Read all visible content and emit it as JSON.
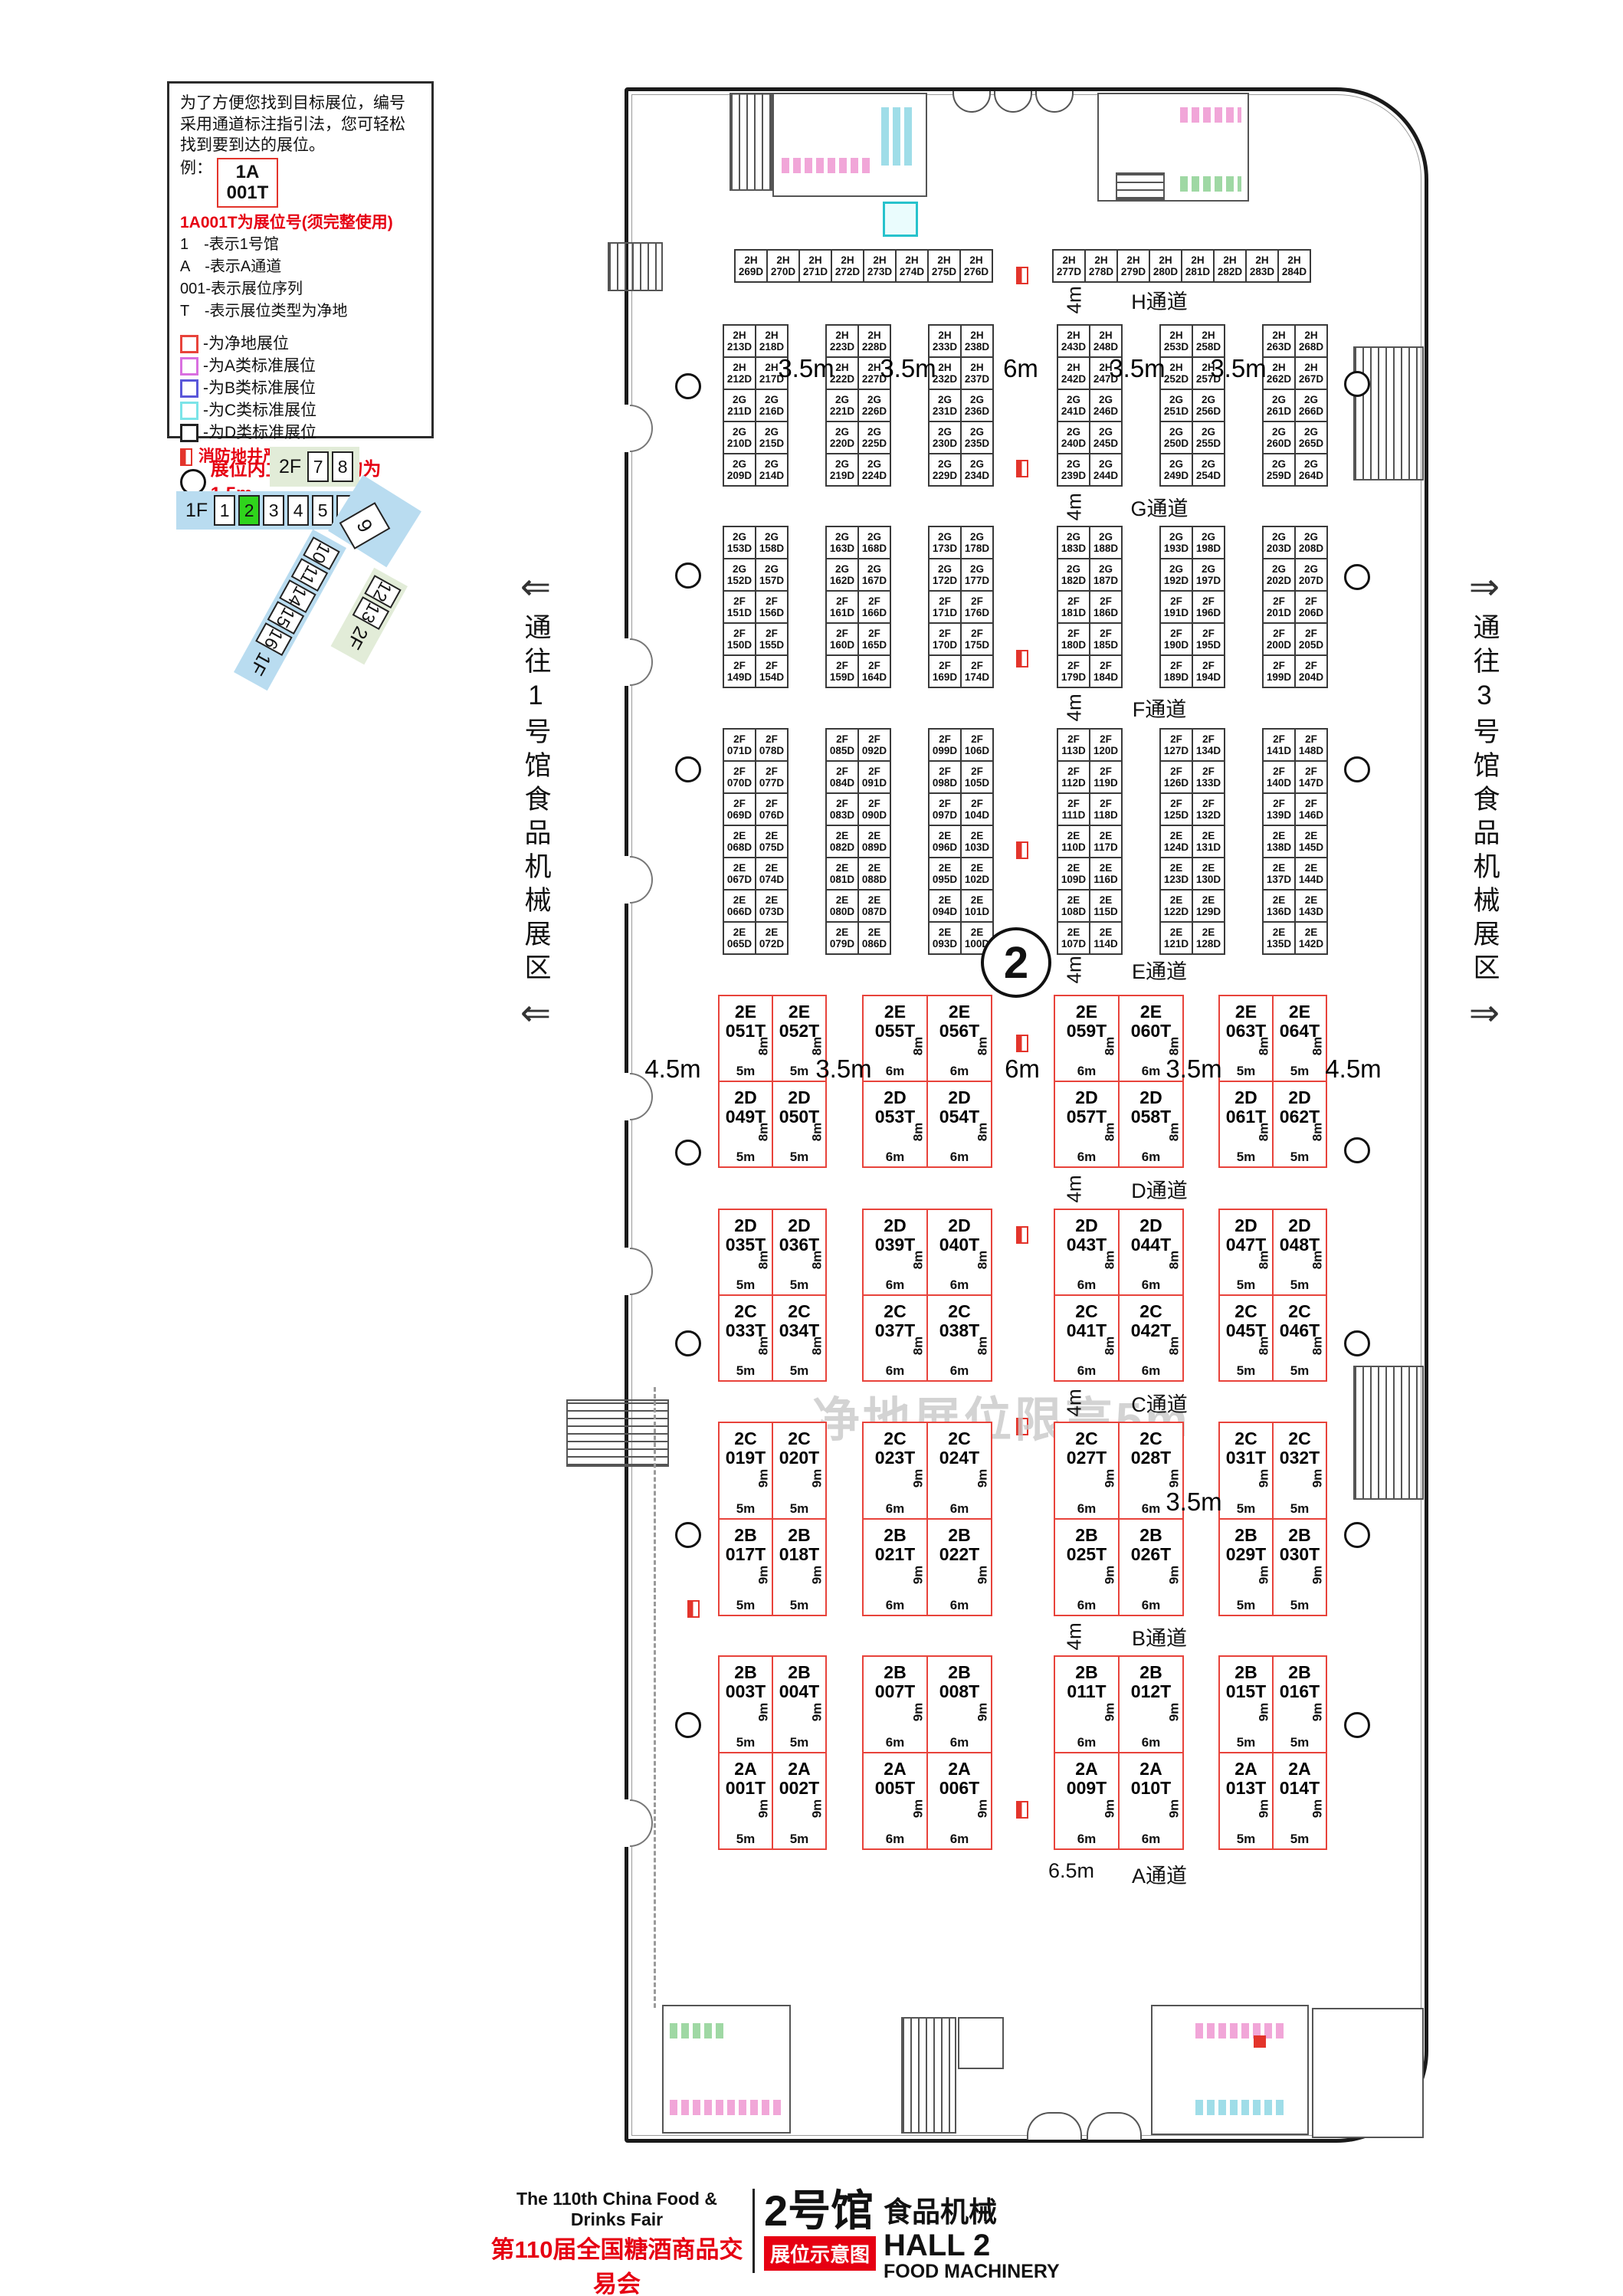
{
  "legend": {
    "intro": "为了方便您找到目标展位，编号采用通道标注指引法，您可轻松找到要到达的展位。",
    "example_label": "例：",
    "example_booth_line1": "1A",
    "example_booth_line2": "001T",
    "booth_no_note": "1A001T为展位号(须完整使用)",
    "notes": [
      "1　-表示1号馆",
      "A　-表示A通道",
      "001-表示展位序列",
      "T　-表示展位类型为净地"
    ],
    "classes": [
      {
        "color": "#e8433b",
        "label": "-为净地展位"
      },
      {
        "color": "#d96fe0",
        "label": "-为A类标准展位"
      },
      {
        "color": "#5a57d9",
        "label": "-为B类标准展位"
      },
      {
        "color": "#7ce4e8",
        "label": "-为C类标准展位"
      },
      {
        "color": "#222222",
        "label": "-为D类标准展位"
      }
    ],
    "fire_note": "消防地井严禁遮挡",
    "column_note": "展位内立柱 直径均为1.5m"
  },
  "minimap": {
    "floor2_label": "2F",
    "floor2_halls": [
      "7",
      "8"
    ],
    "floor1_label": "1F",
    "floor1_halls": [
      "1",
      "2",
      "3",
      "4",
      "5",
      "6"
    ],
    "current_hall": "2",
    "hall9": "9",
    "diag1_halls": [
      "10",
      "11",
      "14",
      "15",
      "16"
    ],
    "diag1_label": "1F",
    "diag2_halls": [
      "12",
      "13"
    ],
    "diag2_label": "2F",
    "highlight_color": "#2fd41c",
    "blue": "#b9dcf0",
    "green": "#e2ecd8"
  },
  "corridors": {
    "left": "通往1号馆食品机械展区",
    "right": "通往3号馆食品机械展区"
  },
  "hall_badge": "2",
  "watermark": "净地展位限高5m",
  "plan": {
    "top_row_left": [
      "2H269D",
      "2H270D",
      "2H271D",
      "2H272D",
      "2H273D",
      "2H274D",
      "2H275D",
      "2H276D"
    ],
    "top_row_right": [
      "2H277D",
      "2H278D",
      "2H279D",
      "2H280D",
      "2H281D",
      "2H282D",
      "2H283D",
      "2H284D"
    ],
    "grid_hg": [
      [
        [
          "2H213D",
          "2H218D"
        ],
        [
          "2H212D",
          "2H217D"
        ],
        [
          "2G211D",
          "2G216D"
        ],
        [
          "2G210D",
          "2G215D"
        ],
        [
          "2G209D",
          "2G214D"
        ]
      ],
      [
        [
          "2H223D",
          "2H228D"
        ],
        [
          "2H222D",
          "2H227D"
        ],
        [
          "2G221D",
          "2G226D"
        ],
        [
          "2G220D",
          "2G225D"
        ],
        [
          "2G219D",
          "2G224D"
        ]
      ],
      [
        [
          "2H233D",
          "2H238D"
        ],
        [
          "2H232D",
          "2H237D"
        ],
        [
          "2G231D",
          "2G236D"
        ],
        [
          "2G230D",
          "2G235D"
        ],
        [
          "2G229D",
          "2G234D"
        ]
      ],
      [
        [
          "2H243D",
          "2H248D"
        ],
        [
          "2H242D",
          "2H247D"
        ],
        [
          "2G241D",
          "2G246D"
        ],
        [
          "2G240D",
          "2G245D"
        ],
        [
          "2G239D",
          "2G244D"
        ]
      ],
      [
        [
          "2H253D",
          "2H258D"
        ],
        [
          "2H252D",
          "2H257D"
        ],
        [
          "2G251D",
          "2G256D"
        ],
        [
          "2G250D",
          "2G255D"
        ],
        [
          "2G249D",
          "2G254D"
        ]
      ],
      [
        [
          "2H263D",
          "2H268D"
        ],
        [
          "2H262D",
          "2H267D"
        ],
        [
          "2G261D",
          "2G266D"
        ],
        [
          "2G260D",
          "2G265D"
        ],
        [
          "2G259D",
          "2G264D"
        ]
      ]
    ],
    "grid_gf": [
      [
        [
          "2G153D",
          "2G158D"
        ],
        [
          "2G152D",
          "2G157D"
        ],
        [
          "2F151D",
          "2F156D"
        ],
        [
          "2F150D",
          "2F155D"
        ],
        [
          "2F149D",
          "2F154D"
        ]
      ],
      [
        [
          "2G163D",
          "2G168D"
        ],
        [
          "2G162D",
          "2G167D"
        ],
        [
          "2F161D",
          "2F166D"
        ],
        [
          "2F160D",
          "2F165D"
        ],
        [
          "2F159D",
          "2F164D"
        ]
      ],
      [
        [
          "2G173D",
          "2G178D"
        ],
        [
          "2G172D",
          "2G177D"
        ],
        [
          "2F171D",
          "2F176D"
        ],
        [
          "2F170D",
          "2F175D"
        ],
        [
          "2F169D",
          "2F174D"
        ]
      ],
      [
        [
          "2G183D",
          "2G188D"
        ],
        [
          "2G182D",
          "2G187D"
        ],
        [
          "2F181D",
          "2F186D"
        ],
        [
          "2F180D",
          "2F185D"
        ],
        [
          "2F179D",
          "2F184D"
        ]
      ],
      [
        [
          "2G193D",
          "2G198D"
        ],
        [
          "2G192D",
          "2G197D"
        ],
        [
          "2F191D",
          "2F196D"
        ],
        [
          "2F190D",
          "2F195D"
        ],
        [
          "2F189D",
          "2F194D"
        ]
      ],
      [
        [
          "2G203D",
          "2G208D"
        ],
        [
          "2G202D",
          "2G207D"
        ],
        [
          "2F201D",
          "2F206D"
        ],
        [
          "2F200D",
          "2F205D"
        ],
        [
          "2F199D",
          "2F204D"
        ]
      ]
    ],
    "grid_fe": [
      [
        [
          "2F071D",
          "2F078D"
        ],
        [
          "2F070D",
          "2F077D"
        ],
        [
          "2F069D",
          "2F076D"
        ],
        [
          "2E068D",
          "2E075D"
        ],
        [
          "2E067D",
          "2E074D"
        ],
        [
          "2E066D",
          "2E073D"
        ],
        [
          "2E065D",
          "2E072D"
        ]
      ],
      [
        [
          "2F085D",
          "2F092D"
        ],
        [
          "2F084D",
          "2F091D"
        ],
        [
          "2F083D",
          "2F090D"
        ],
        [
          "2E082D",
          "2E089D"
        ],
        [
          "2E081D",
          "2E088D"
        ],
        [
          "2E080D",
          "2E087D"
        ],
        [
          "2E079D",
          "2E086D"
        ]
      ],
      [
        [
          "2F099D",
          "2F106D"
        ],
        [
          "2F098D",
          "2F105D"
        ],
        [
          "2F097D",
          "2F104D"
        ],
        [
          "2E096D",
          "2E103D"
        ],
        [
          "2E095D",
          "2E102D"
        ],
        [
          "2E094D",
          "2E101D"
        ],
        [
          "2E093D",
          "2E100D"
        ]
      ],
      [
        [
          "2F113D",
          "2F120D"
        ],
        [
          "2F112D",
          "2F119D"
        ],
        [
          "2F111D",
          "2F118D"
        ],
        [
          "2E110D",
          "2E117D"
        ],
        [
          "2E109D",
          "2E116D"
        ],
        [
          "2E108D",
          "2E115D"
        ],
        [
          "2E107D",
          "2E114D"
        ]
      ],
      [
        [
          "2F127D",
          "2F134D"
        ],
        [
          "2F126D",
          "2F133D"
        ],
        [
          "2F125D",
          "2F132D"
        ],
        [
          "2E124D",
          "2E131D"
        ],
        [
          "2E123D",
          "2E130D"
        ],
        [
          "2E122D",
          "2E129D"
        ],
        [
          "2E121D",
          "2E128D"
        ]
      ],
      [
        [
          "2F141D",
          "2F148D"
        ],
        [
          "2F140D",
          "2F147D"
        ],
        [
          "2F139D",
          "2F146D"
        ],
        [
          "2E138D",
          "2E145D"
        ],
        [
          "2E137D",
          "2E144D"
        ],
        [
          "2E136D",
          "2E143D"
        ],
        [
          "2E135D",
          "2E142D"
        ]
      ]
    ],
    "t_sections": [
      {
        "height": "8m",
        "widths": [
          "5m",
          "6m",
          "6m",
          "5m"
        ],
        "blocks": [
          [
            [
              "2E051T",
              "2E052T"
            ],
            [
              "2D049T",
              "2D050T"
            ]
          ],
          [
            [
              "2E055T",
              "2E056T"
            ],
            [
              "2D053T",
              "2D054T"
            ]
          ],
          [
            [
              "2E059T",
              "2E060T"
            ],
            [
              "2D057T",
              "2D058T"
            ]
          ],
          [
            [
              "2E063T",
              "2E064T"
            ],
            [
              "2D061T",
              "2D062T"
            ]
          ]
        ]
      },
      {
        "height": "8m",
        "widths": [
          "5m",
          "6m",
          "6m",
          "5m"
        ],
        "blocks": [
          [
            [
              "2D035T",
              "2D036T"
            ],
            [
              "2C033T",
              "2C034T"
            ]
          ],
          [
            [
              "2D039T",
              "2D040T"
            ],
            [
              "2C037T",
              "2C038T"
            ]
          ],
          [
            [
              "2D043T",
              "2D044T"
            ],
            [
              "2C041T",
              "2C042T"
            ]
          ],
          [
            [
              "2D047T",
              "2D048T"
            ],
            [
              "2C045T",
              "2C046T"
            ]
          ]
        ]
      },
      {
        "height": "9m",
        "widths": [
          "5m",
          "6m",
          "6m",
          "5m"
        ],
        "blocks": [
          [
            [
              "2C019T",
              "2C020T"
            ],
            [
              "2B017T",
              "2B018T"
            ]
          ],
          [
            [
              "2C023T",
              "2C024T"
            ],
            [
              "2B021T",
              "2B022T"
            ]
          ],
          [
            [
              "2C027T",
              "2C028T"
            ],
            [
              "2B025T",
              "2B026T"
            ]
          ],
          [
            [
              "2C031T",
              "2C032T"
            ],
            [
              "2B029T",
              "2B030T"
            ]
          ]
        ]
      },
      {
        "height": "9m",
        "widths": [
          "5m",
          "6m",
          "6m",
          "5m"
        ],
        "blocks": [
          [
            [
              "2B003T",
              "2B004T"
            ],
            [
              "2A001T",
              "2A002T"
            ]
          ],
          [
            [
              "2B007T",
              "2B008T"
            ],
            [
              "2A005T",
              "2A006T"
            ]
          ],
          [
            [
              "2B011T",
              "2B012T"
            ],
            [
              "2A009T",
              "2A010T"
            ]
          ],
          [
            [
              "2B015T",
              "2B016T"
            ],
            [
              "2A013T",
              "2A014T"
            ]
          ]
        ]
      }
    ],
    "aisles": [
      {
        "name": "H通道",
        "dim": "4m"
      },
      {
        "name": "G通道",
        "dim": "4m"
      },
      {
        "name": "F通道",
        "dim": "4m"
      },
      {
        "name": "E通道",
        "dim": "4m"
      },
      {
        "name": "D通道",
        "dim": "4m"
      },
      {
        "name": "C通道",
        "dim": "4m"
      },
      {
        "name": "B通道",
        "dim": "4m"
      },
      {
        "name": "A通道",
        "dim": "6.5m"
      }
    ],
    "spacers_h": [
      "3.5m",
      "3.5m",
      "6m",
      "3.5m",
      "3.5m"
    ],
    "spacers_e": [
      "4.5m",
      "3.5m",
      "6m",
      "3.5m",
      "4.5m"
    ],
    "spacers_c": [
      "3.5m"
    ]
  },
  "footer": {
    "en_title": "The 110th China Food & Drinks Fair",
    "cn_title": "第110届全国糖酒商品交易会",
    "venue": "中国西部国际博览城",
    "hall_cn": "2号馆",
    "hall_category_cn": "食品机械",
    "badge": "展位示意图",
    "hall_en": "HALL 2",
    "hall_category_en": "FOOD MACHINERY"
  }
}
